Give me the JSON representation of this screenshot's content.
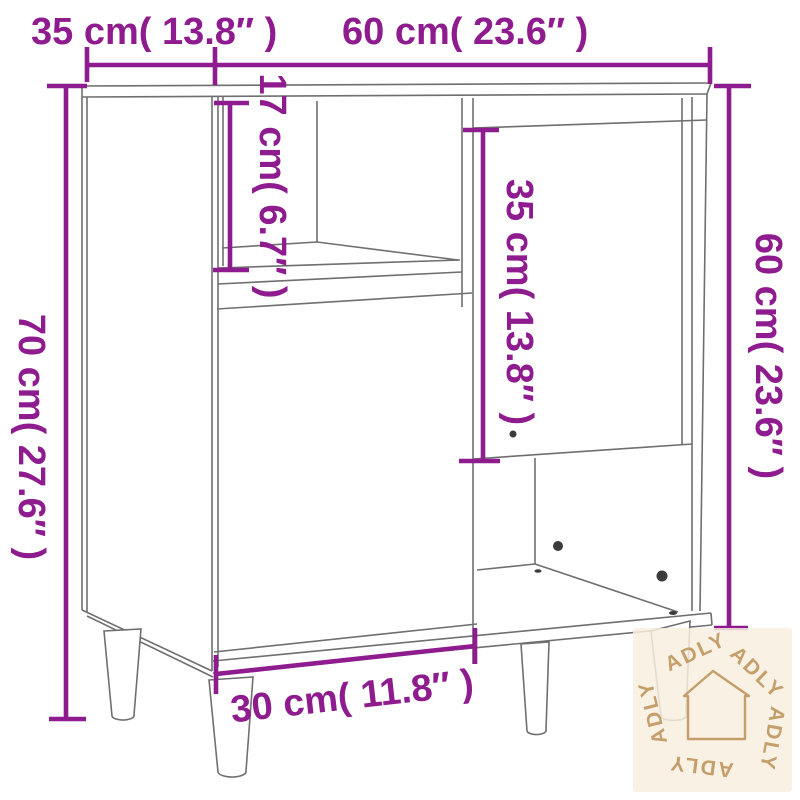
{
  "diagram": {
    "product": "sideboard-dimension-diagram",
    "colors": {
      "dimension": "#8F1C8F",
      "outline": "#6F6F6F",
      "screw": "#3B3B3B"
    },
    "dimensions": {
      "depth_top": "35 cm( 13.8″ )",
      "width_top": "60 cm( 23.6″ )",
      "height_left": "70 cm( 27.6″ )",
      "body_height_right": "60 cm( 23.6″ )",
      "open_shelf_height": "17 cm( 6.7″ )",
      "right_door_height": "35 cm( 13.8″ )",
      "left_door_width": "30 cm( 11.8″ )"
    }
  },
  "watermark": {
    "brand": "ADLY",
    "icon": "house-outline-icon",
    "bg_color": "#F8EEDF",
    "fg_color": "#C49F6B"
  }
}
